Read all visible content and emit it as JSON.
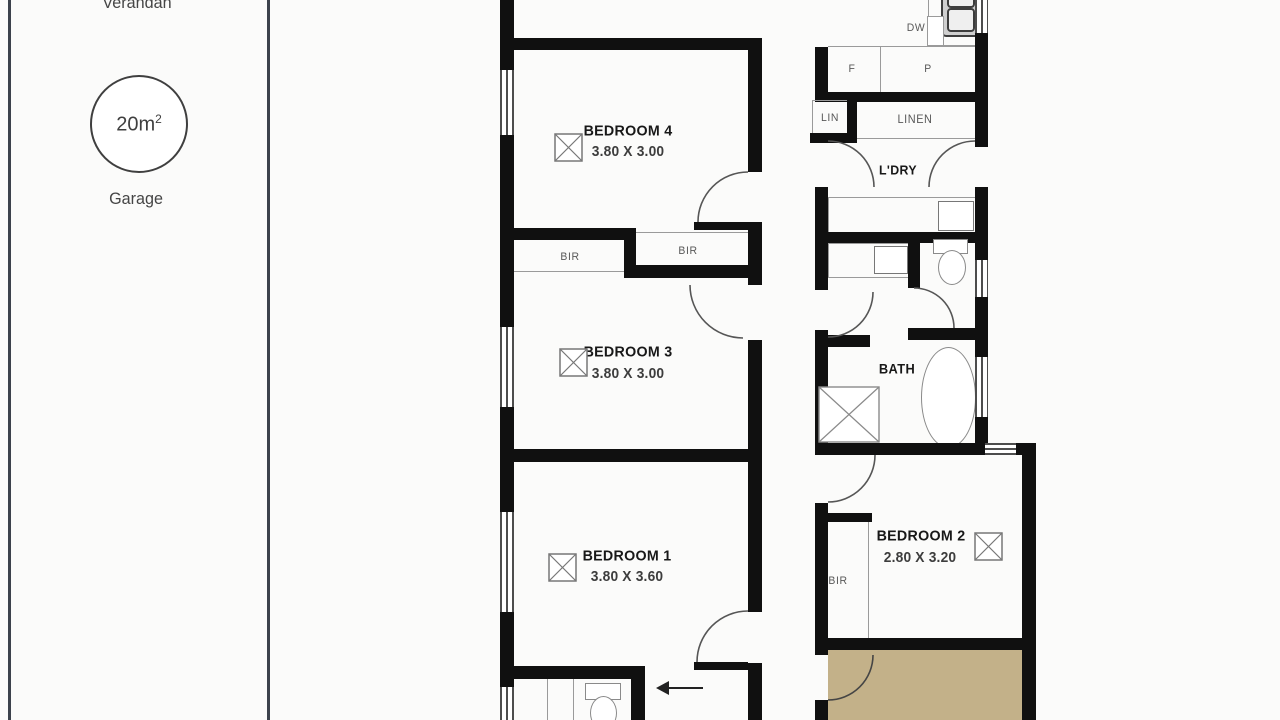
{
  "site": {
    "verandah": "Verandah",
    "garage_area": "20m",
    "garage_area_sup": "2",
    "garage": "Garage"
  },
  "rooms": {
    "bedroom4": {
      "name": "BEDROOM 4",
      "dims": "3.80 X 3.00"
    },
    "bedroom3": {
      "name": "BEDROOM 3",
      "dims": "3.80 X 3.00"
    },
    "bedroom1": {
      "name": "BEDROOM 1",
      "dims": "3.80 X 3.60"
    },
    "bedroom2": {
      "name": "BEDROOM 2",
      "dims": "2.80 X 3.20"
    },
    "bath": "BATH",
    "laundry": "L'DRY"
  },
  "labels": {
    "bir_left": "BIR",
    "bir_right": "BIR",
    "bir_bed2": "BIR",
    "lin": "LIN",
    "linen": "LINEN",
    "fridge": "F",
    "pantry": "P",
    "dishwasher": "DW"
  },
  "colors": {
    "wall": "#101010",
    "deck": "#c3b189",
    "boundary": "#3c424c",
    "fixture_line": "#9a9a9a",
    "window_line": "#4d4d4d",
    "text_dark": "#181818",
    "text_gray": "#585858",
    "background": "#fbfbfa"
  }
}
